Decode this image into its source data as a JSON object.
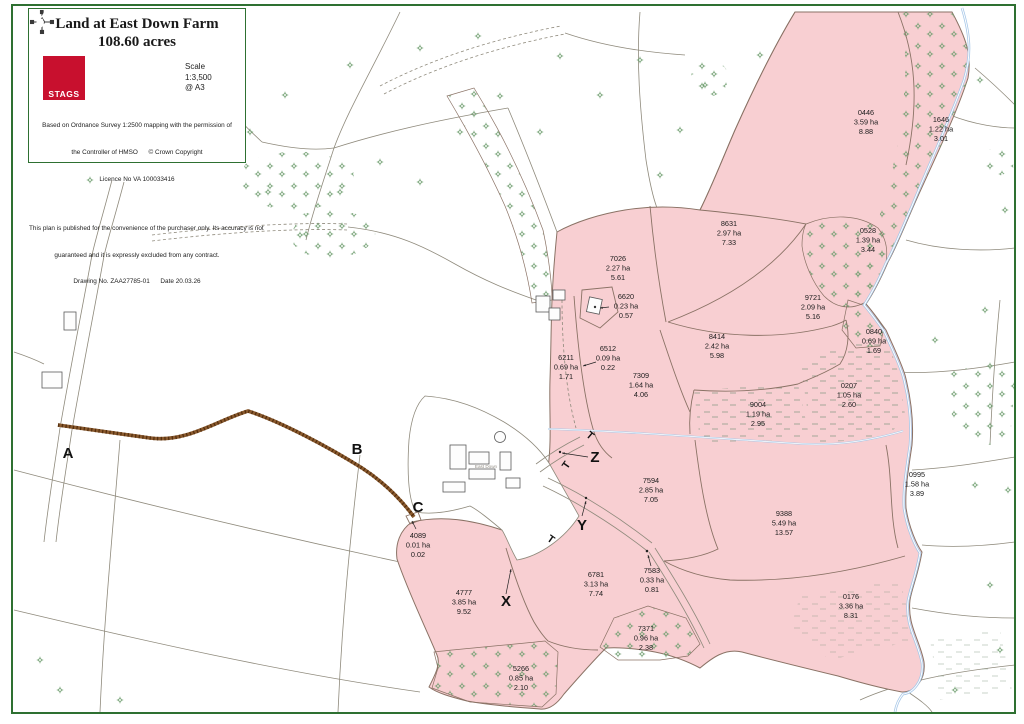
{
  "title_block": {
    "title": "Land at East Down Farm",
    "subtitle": "108.60 acres",
    "logo_text": "STAGS",
    "scale_label": "Scale",
    "scale_ratio": "1:3,500",
    "scale_sheet": "@ A3",
    "attribution": [
      "Based on Ordnance Survey 1:2500 mapping with the permission of",
      "the Controller of HMSO      © Crown Copyright",
      "Licence No VA 100033416"
    ],
    "disclaimer": [
      "This plan is published for the convenience of the purchaser only. Its accuracy is not",
      "guaranteed and it is expressly excluded from any contract.",
      "Drawing No. ZAA27785-01      Date 20.03.26"
    ]
  },
  "map": {
    "highlight_color": "#f8cfd2",
    "place_label": "East Down",
    "gate_label": "T",
    "parcels": [
      {
        "id": "0446",
        "ha": "3.59 ha",
        "ac": "8.88"
      },
      {
        "id": "1646",
        "ha": "1.22 ha",
        "ac": "3.01"
      },
      {
        "id": "0528",
        "ha": "1.39 ha",
        "ac": "3.44"
      },
      {
        "id": "8631",
        "ha": "2.97 ha",
        "ac": "7.33"
      },
      {
        "id": "7026",
        "ha": "2.27 ha",
        "ac": "5.61"
      },
      {
        "id": "6620",
        "ha": "0.23 ha",
        "ac": "0.57"
      },
      {
        "id": "9721",
        "ha": "2.09 ha",
        "ac": "5.16"
      },
      {
        "id": "8414",
        "ha": "2.42 ha",
        "ac": "5.98"
      },
      {
        "id": "6211",
        "ha": "0.69 ha",
        "ac": "1.71"
      },
      {
        "id": "6512",
        "ha": "0.09 ha",
        "ac": "0.22"
      },
      {
        "id": "7309",
        "ha": "1.64 ha",
        "ac": "4.06"
      },
      {
        "id": "9004",
        "ha": "1.19 ha",
        "ac": "2.95"
      },
      {
        "id": "0840",
        "ha": "0.69 ha",
        "ac": "1.69"
      },
      {
        "id": "0207",
        "ha": "1.05 ha",
        "ac": "2.60"
      },
      {
        "id": "0995",
        "ha": "1.58 ha",
        "ac": "3.89"
      },
      {
        "id": "7594",
        "ha": "2.85 ha",
        "ac": "7.05"
      },
      {
        "id": "9388",
        "ha": "5.49 ha",
        "ac": "13.57"
      },
      {
        "id": "6781",
        "ha": "3.13 ha",
        "ac": "7.74"
      },
      {
        "id": "7583",
        "ha": "0.33 ha",
        "ac": "0.81"
      },
      {
        "id": "4089",
        "ha": "0.01 ha",
        "ac": "0.02"
      },
      {
        "id": "4777",
        "ha": "3.85 ha",
        "ac": "9.52"
      },
      {
        "id": "5266",
        "ha": "0.85 ha",
        "ac": "2.10"
      },
      {
        "id": "7371",
        "ha": "0.96 ha",
        "ac": "2.38"
      },
      {
        "id": "0176",
        "ha": "3.36 ha",
        "ac": "8.31"
      }
    ],
    "route_markers": [
      {
        "label": "A"
      },
      {
        "label": "B"
      },
      {
        "label": "C"
      },
      {
        "label": "X"
      },
      {
        "label": "Y"
      },
      {
        "label": "Z"
      }
    ]
  },
  "colors": {
    "stags_red": "#c8102e",
    "border_green": "#2e7031",
    "stream_blue": "#a8c8e8",
    "track_brown": "#8a5a2e",
    "tree_green": "#6f9e6f"
  }
}
